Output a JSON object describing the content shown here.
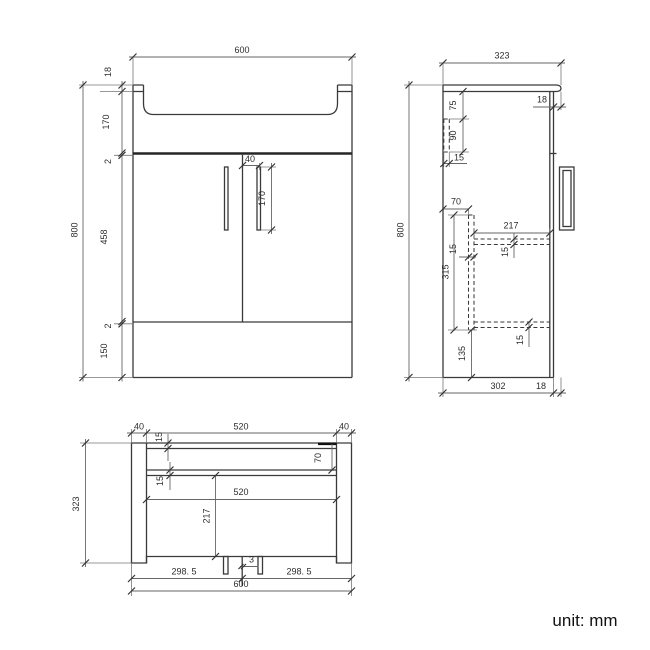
{
  "front": {
    "width": "600",
    "height": "800",
    "rim_thickness": "18",
    "basin_depth": "170",
    "gap_top": "2",
    "door_height": "458",
    "gap_bottom": "2",
    "plinth_height": "150",
    "handle_offset": "40",
    "handle_length": "170"
  },
  "side": {
    "depth": "323",
    "height": "800",
    "top_overhang": "18",
    "rail_drop": "75",
    "rail_height": "90",
    "rail_thickness": "15",
    "divider_offset": "70",
    "shelf_depth": "217",
    "shelf_thickness": "15",
    "divider_thickness": "15",
    "divider_height": "315",
    "bottom_shelf_thickness": "15",
    "bottom_clearance": "135",
    "body_depth": "302",
    "front_overhang": "18"
  },
  "plan": {
    "gable_left": "40",
    "opening_width": "520",
    "gable_right": "40",
    "back_thickness": "15",
    "rail_offset": "70",
    "rail_thickness": "15",
    "opening_width_mid": "520",
    "interior_depth": "217",
    "door_left": "298. 5",
    "door_gap": "3",
    "door_right": "298. 5",
    "width": "600",
    "depth": "323"
  },
  "footer": {
    "unit_label": "unit: mm"
  }
}
